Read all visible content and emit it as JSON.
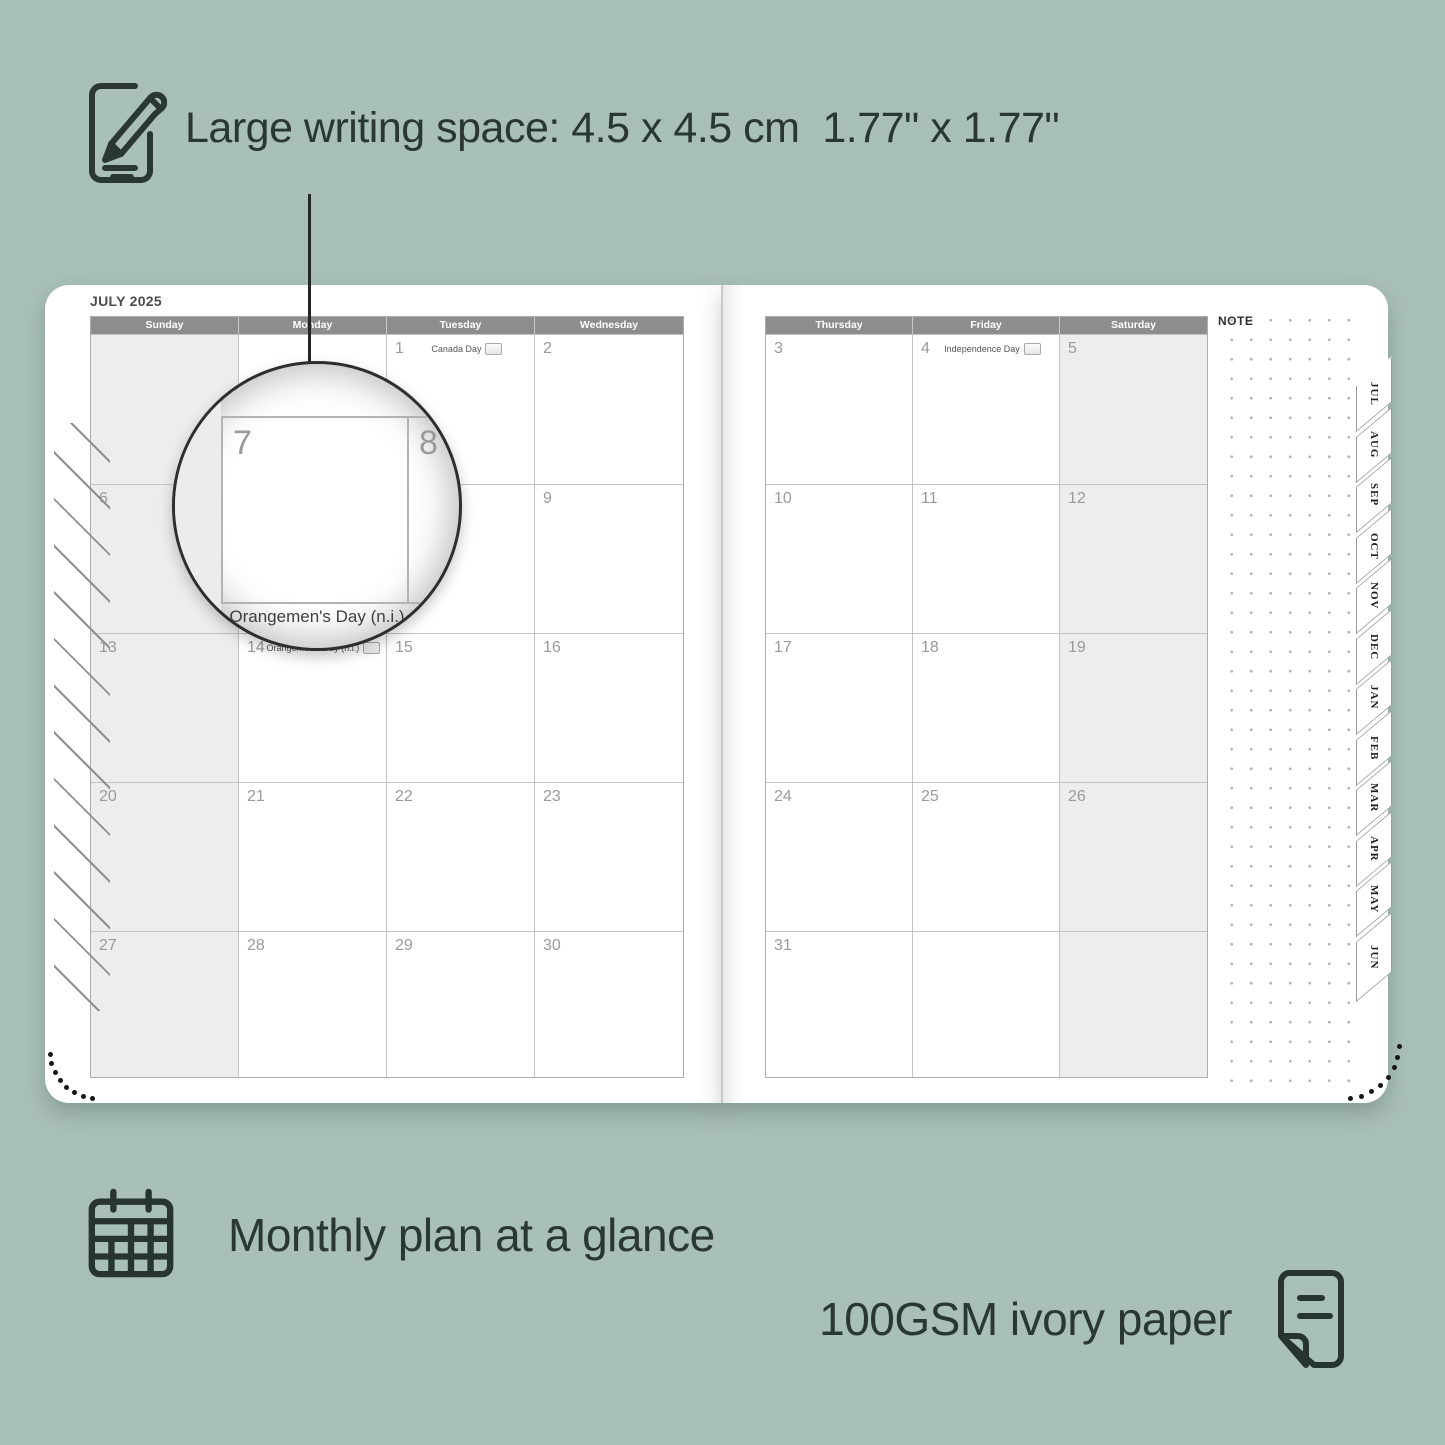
{
  "colors": {
    "background": "#a9c0b9",
    "ink": "#2a3833",
    "header_bar": "#8d8d8d",
    "weekend_fill": "#ededed",
    "grid_line": "#c3c3c3",
    "day_number": "#9a9a9a"
  },
  "headline": {
    "icon": "pencil-note-icon",
    "text": "Large writing space: 4.5 x 4.5 cm  1.77\" x 1.77\""
  },
  "planner": {
    "month_title": "JULY 2025",
    "note_label": "NOTE",
    "weekday_headers_left": [
      "Sunday",
      "Monday",
      "Tuesday",
      "Wednesday"
    ],
    "weekday_headers_right": [
      "Thursday",
      "Friday",
      "Saturday"
    ],
    "weeks_left": [
      [
        {
          "day": ""
        },
        {
          "day": ""
        },
        {
          "day": "1",
          "holiday": "Canada Day",
          "flag": true
        },
        {
          "day": "2"
        }
      ],
      [
        {
          "day": "6"
        },
        {
          "day": "7"
        },
        {
          "day": "8"
        },
        {
          "day": "9"
        }
      ],
      [
        {
          "day": "13"
        },
        {
          "day": "14",
          "holiday": "Orangemen's Day (n.i.)",
          "flag": true
        },
        {
          "day": "15"
        },
        {
          "day": "16"
        }
      ],
      [
        {
          "day": "20"
        },
        {
          "day": "21"
        },
        {
          "day": "22"
        },
        {
          "day": "23"
        }
      ],
      [
        {
          "day": "27"
        },
        {
          "day": "28"
        },
        {
          "day": "29"
        },
        {
          "day": "30"
        }
      ]
    ],
    "weeks_right": [
      [
        {
          "day": "3"
        },
        {
          "day": "4",
          "holiday": "Independence Day",
          "flag": true
        },
        {
          "day": "5"
        }
      ],
      [
        {
          "day": "10"
        },
        {
          "day": "11"
        },
        {
          "day": "12"
        }
      ],
      [
        {
          "day": "17"
        },
        {
          "day": "18"
        },
        {
          "day": "19"
        }
      ],
      [
        {
          "day": "24"
        },
        {
          "day": "25"
        },
        {
          "day": "26"
        }
      ],
      [
        {
          "day": "31"
        },
        {
          "day": ""
        },
        {
          "day": ""
        }
      ]
    ],
    "month_tabs": [
      "JUL",
      "AUG",
      "SEP",
      "OCT",
      "NOV",
      "DEC",
      "JAN",
      "FEB",
      "MAR",
      "APR",
      "MAY",
      "JUN"
    ],
    "magnifier": {
      "day_a": "7",
      "day_b": "8",
      "holiday": "Orangemen's Day (n.i.)"
    }
  },
  "features": [
    {
      "icon": "calendar-grid-icon",
      "text": "Monthly plan at a glance"
    },
    {
      "icon": "paper-sheet-icon",
      "text": "100GSM ivory paper"
    }
  ]
}
